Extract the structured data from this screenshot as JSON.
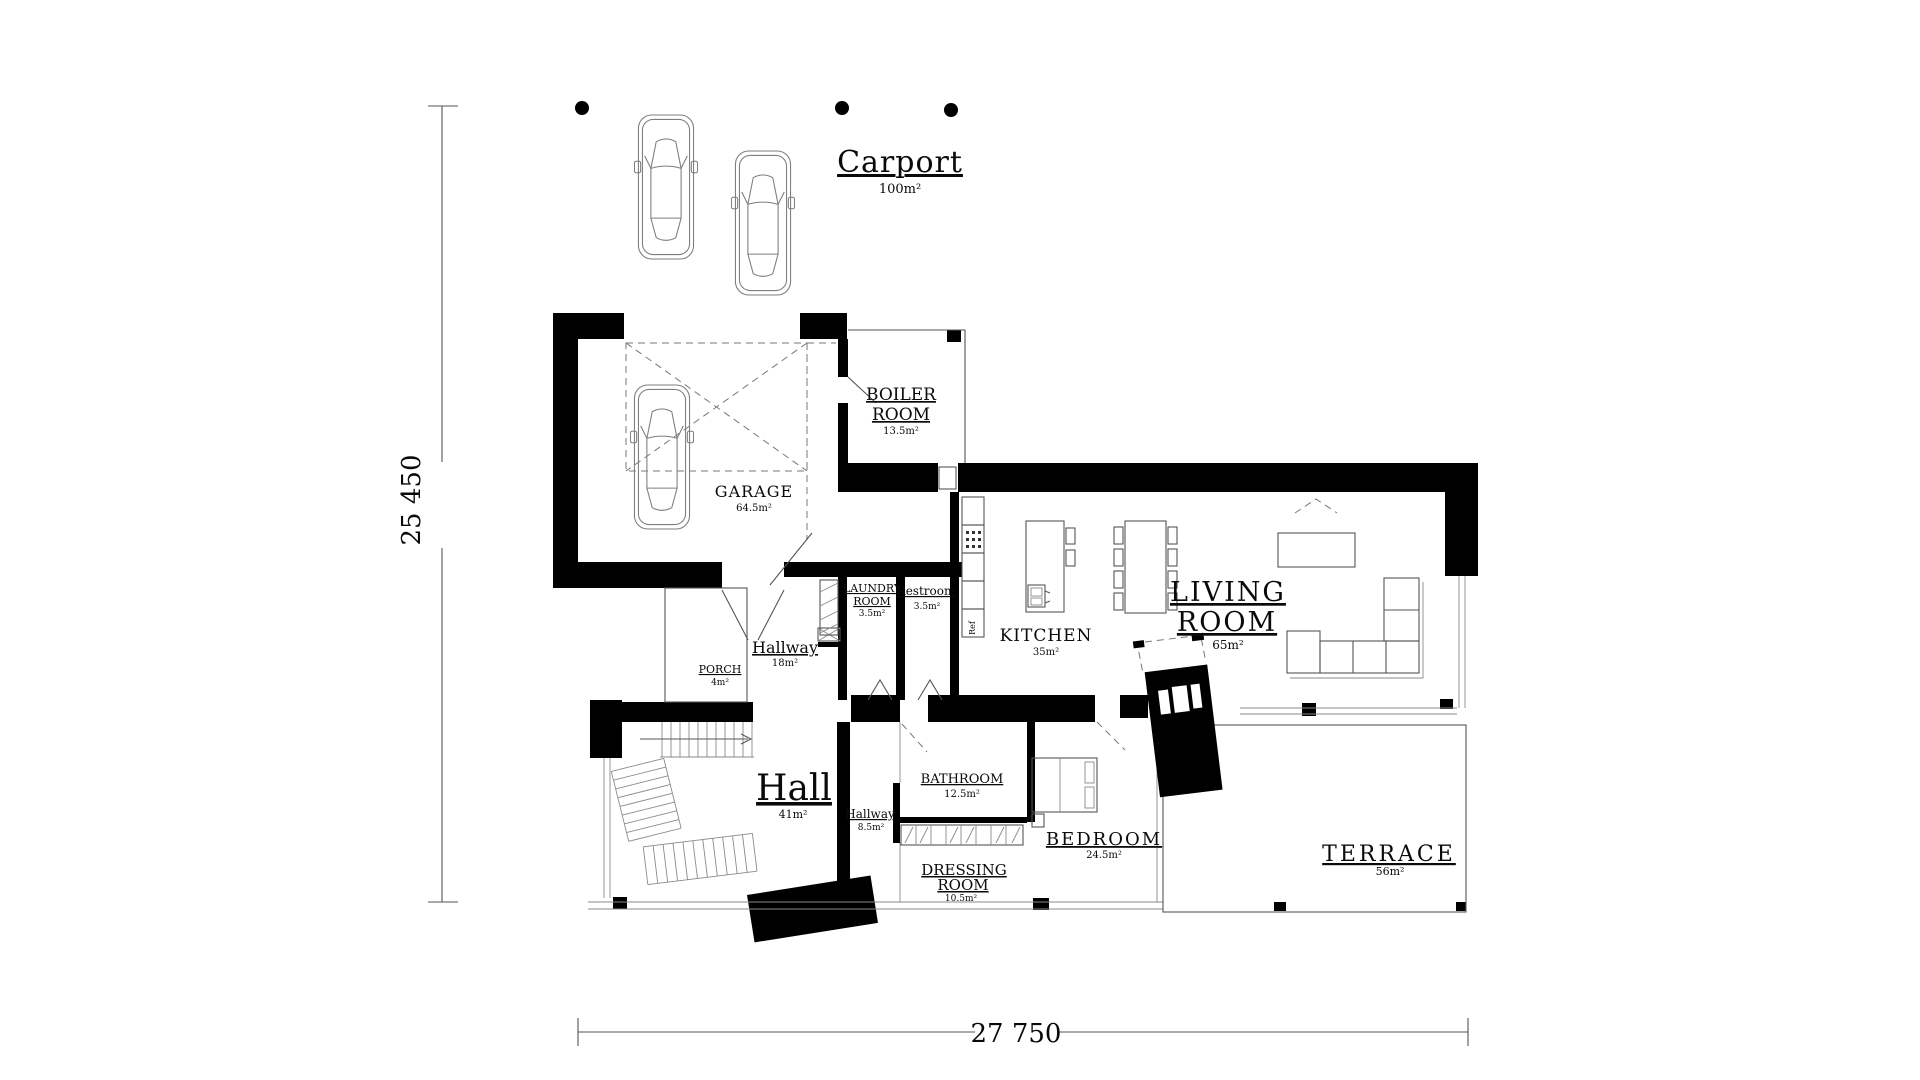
{
  "drawing": {
    "dim_vertical": "25 450",
    "dim_horizontal": "27 750"
  },
  "rooms": {
    "carport": {
      "name": "Carport",
      "area": "100m²"
    },
    "boiler_room": {
      "line1": "BOILER",
      "line2": "ROOM",
      "area": "13.5m²"
    },
    "garage": {
      "name": "GARAGE",
      "area": "64.5m²"
    },
    "laundry_room": {
      "line1": "LAUNDRY",
      "line2": "ROOM",
      "area": "3.5m²"
    },
    "restroom": {
      "name": "Restroom",
      "area": "3.5m²"
    },
    "kitchen": {
      "name": "KITCHEN",
      "area": "35m²"
    },
    "living_room": {
      "line1": "LIVING",
      "line2": "ROOM",
      "area": "65m²"
    },
    "hallway_main": {
      "name": "Hallway",
      "area": "18m²"
    },
    "porch": {
      "name": "PORCH",
      "area": "4m²"
    },
    "hall": {
      "name": "Hall",
      "area": "41m²"
    },
    "bathroom": {
      "name": "BATHROOM",
      "area": "12.5m²"
    },
    "hallway_bedroom": {
      "name": "Hallway",
      "area": "8.5m²"
    },
    "bedroom": {
      "name": "BEDROOM",
      "area": "24.5m²"
    },
    "dressing_room": {
      "line1": "DRESSING",
      "line2": "ROOM",
      "area": "10.5m²"
    },
    "terrace": {
      "name": "TERRACE",
      "area": "56m²"
    }
  },
  "appliances": {
    "fridge": "Ref"
  },
  "colors": {
    "ink": "#000000",
    "paper": "#ffffff",
    "thin_line": "#555555"
  }
}
